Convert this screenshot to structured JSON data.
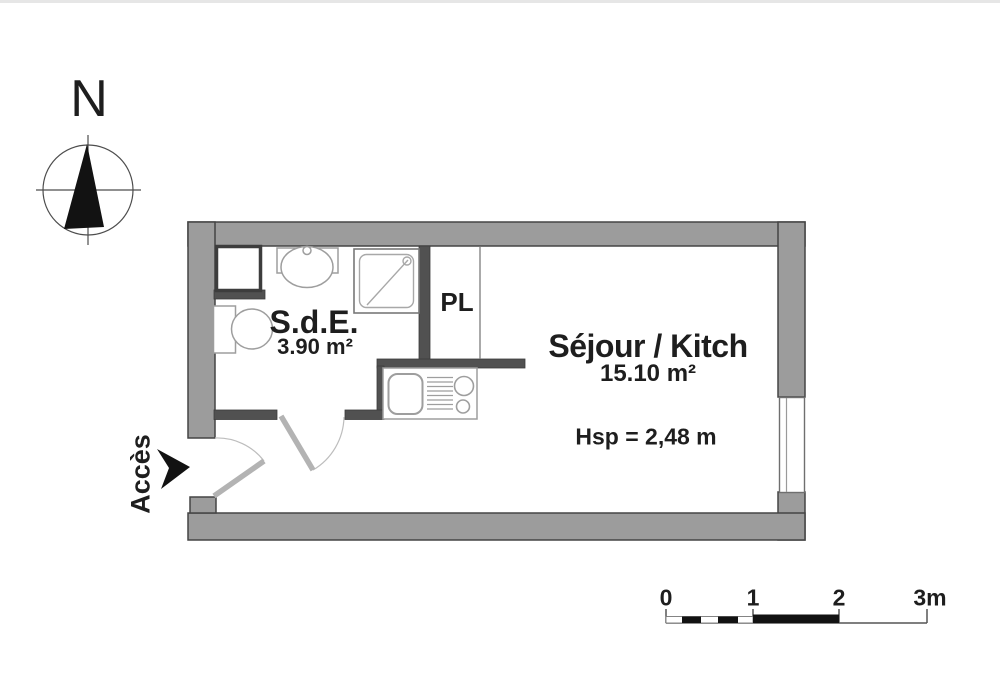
{
  "title": "Studio floor plan",
  "compass": {
    "north_label": "N"
  },
  "entrance": {
    "label": "Accès"
  },
  "rooms": {
    "bathroom": {
      "name": "S.d.E.",
      "area": "3.90 m²"
    },
    "closet": {
      "label": "PL"
    },
    "living_kitchen": {
      "name": "Séjour / Kitch",
      "area": "15.10 m²",
      "ceiling_height": "Hsp = 2,48 m"
    }
  },
  "scale_bar": {
    "ticks": [
      "0",
      "1",
      "2",
      "3m"
    ]
  },
  "colors": {
    "wall_fill": "#9c9c9c",
    "wall_outline": "#454545",
    "interior_wall": "#515151",
    "fixture_stroke": "#9e9e9e",
    "door_stroke": "#b3b3b3",
    "ink": "#1e1e1e"
  }
}
